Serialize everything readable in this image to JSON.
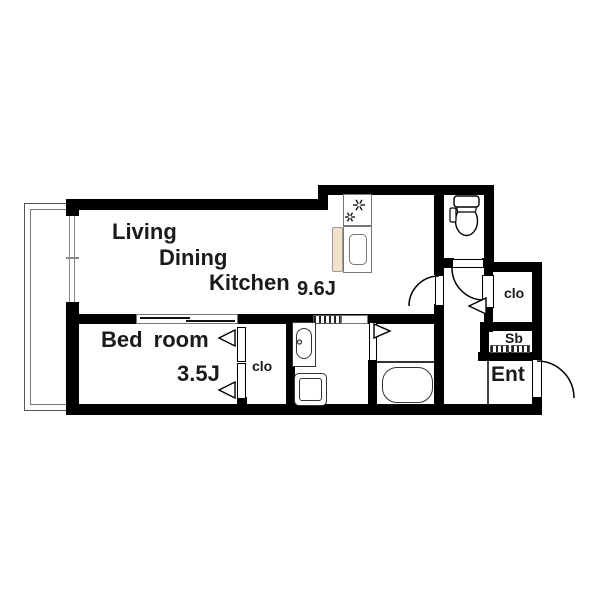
{
  "floorplan": {
    "rooms": {
      "ldk": {
        "line1": "Living",
        "line2": "Dining",
        "line3": "Kitchen",
        "size": "9.6J"
      },
      "bedroom": {
        "name": "Bed room",
        "size": "3.5J"
      },
      "bedroom_closet": {
        "name": "clo"
      },
      "hall_closet": {
        "name": "clo"
      },
      "shoe_box": {
        "name": "Sb"
      },
      "entrance": {
        "name": "Ent"
      }
    },
    "colors": {
      "wall": "#000000",
      "kitchen_counter": "#f3e1ca",
      "fixture_line": "#333333",
      "text": "#1b1b1b"
    }
  }
}
